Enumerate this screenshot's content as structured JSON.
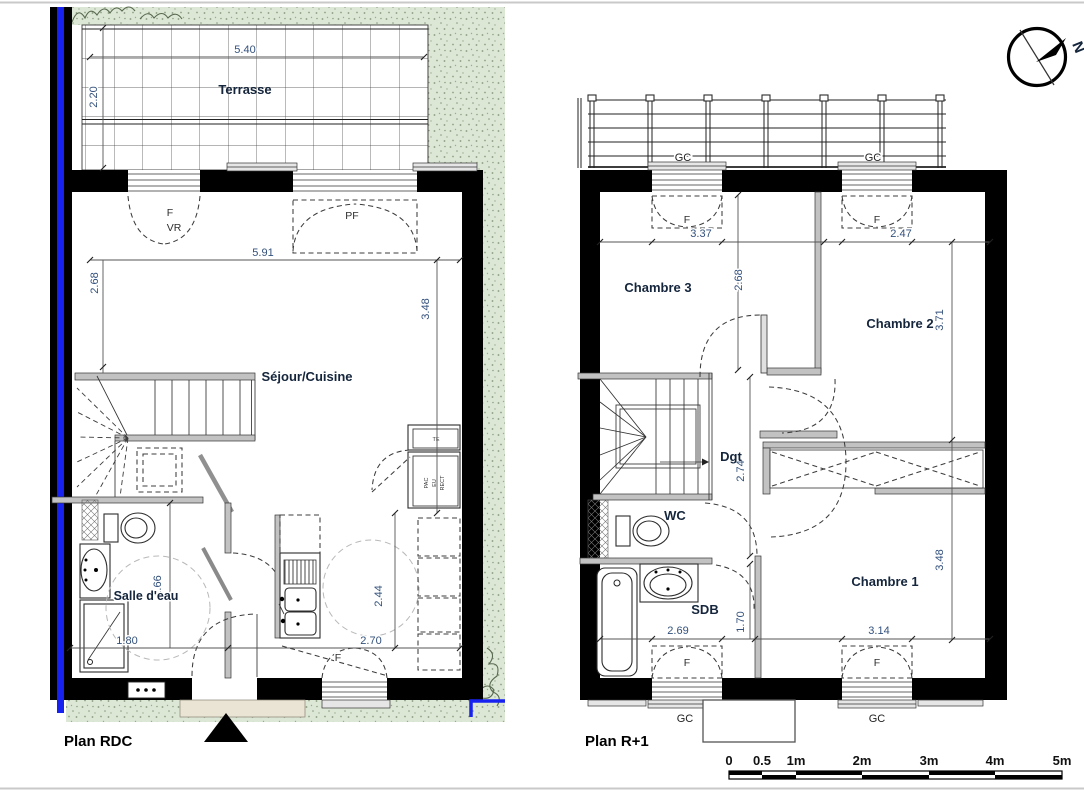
{
  "plan_rdc": {
    "title": "Plan RDC",
    "rooms": {
      "terrasse": "Terrasse",
      "sejour": "Séjour/Cuisine",
      "salle_eau": "Salle d'eau"
    },
    "openings": {
      "f_top": "F",
      "vr": "VR",
      "pf": "PF",
      "f_bottom": "F"
    },
    "equipment": {
      "te": "TE",
      "pac": "PAC",
      "eu": "EU",
      "rect": "RECT"
    },
    "dims": {
      "terrasse_w": "5.40",
      "terrasse_d": "2.20",
      "sejour_w": "5.91",
      "sejour_left": "2.68",
      "sejour_right": "3.48",
      "salle_eau_w": "1.80",
      "salle_eau_d": "1.66",
      "cuisine_w": "2.70",
      "cuisine_d": "2.44"
    }
  },
  "plan_r1": {
    "title": "Plan R+1",
    "rooms": {
      "chambre3": "Chambre 3",
      "chambre2": "Chambre 2",
      "chambre1": "Chambre 1",
      "degagement": "Dgt",
      "wc": "WC",
      "sdb": "SDB"
    },
    "openings": {
      "gc_top_left": "GC",
      "gc_top_right": "GC",
      "f_ch3": "F",
      "f_ch2": "F",
      "f_sdb": "F",
      "f_ch1": "F",
      "gc_bottom_left": "GC",
      "gc_bottom_right": "GC"
    },
    "dims": {
      "ch3_w": "3.37",
      "ch2_w": "2.47",
      "ch3_d": "2.68",
      "ch2_d": "3.71",
      "dgt_d": "2.74",
      "ch1_d": "3.48",
      "sdb_w": "2.69",
      "sdb_d": "1.70",
      "ch1_w": "3.14"
    }
  },
  "compass": {
    "north": "N"
  },
  "scale_bar": {
    "ticks": [
      "0",
      "0.5",
      "1m",
      "2m",
      "3m",
      "4m",
      "5m"
    ]
  },
  "colors": {
    "accent_blue": "#1822f0",
    "dim_text": "#33517c",
    "room_label": "#14253c",
    "green_area": "#dde7d5",
    "wall_black": "#000000"
  }
}
